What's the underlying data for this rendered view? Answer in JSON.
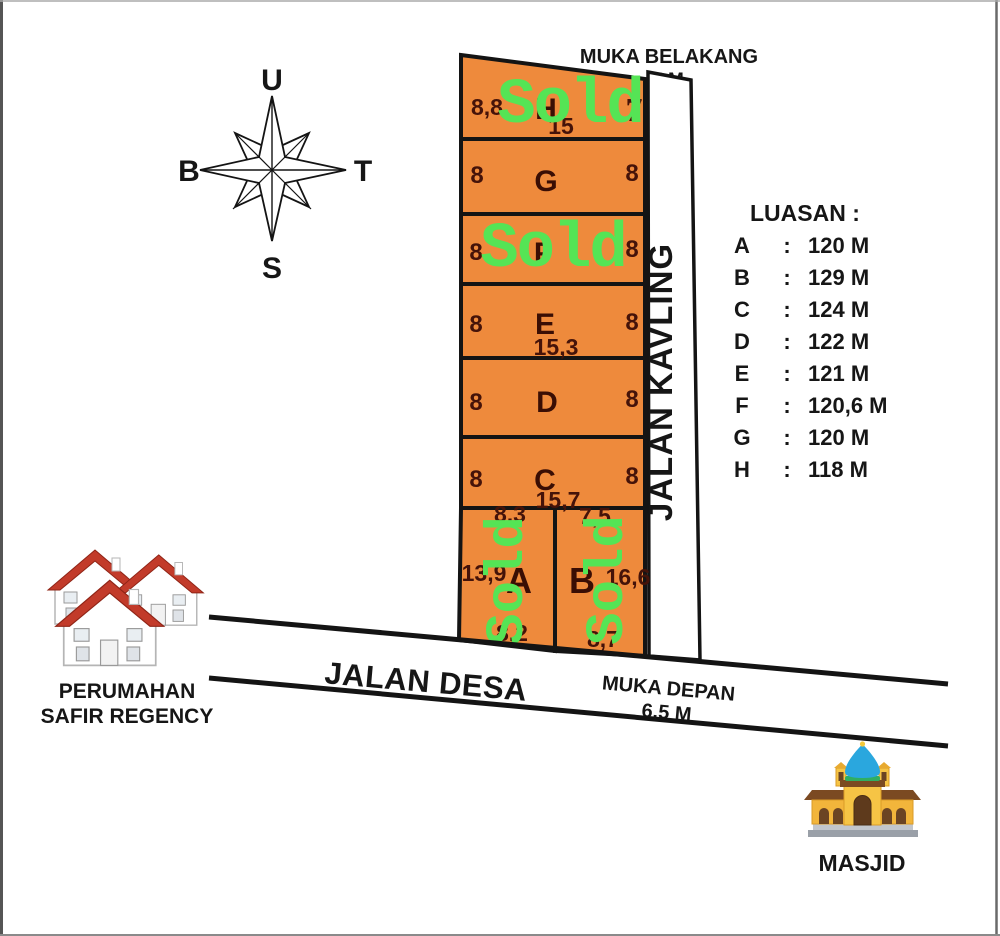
{
  "compass": {
    "north": "U",
    "east": "T",
    "south": "S",
    "west": "B"
  },
  "top_label": {
    "line1": "MUKA BELAKANG",
    "line2": "5 M"
  },
  "kavling_road": {
    "label": "JALAN KAVLING"
  },
  "main_road": {
    "label": "JALAN DESA"
  },
  "front_label": {
    "line1": "MUKA DEPAN",
    "line2": "6,5 M"
  },
  "legend": {
    "title": "LUASAN :",
    "colon": ":",
    "entries": [
      {
        "plot": "A",
        "area": "120 M"
      },
      {
        "plot": "B",
        "area": "129 M"
      },
      {
        "plot": "C",
        "area": "124 M"
      },
      {
        "plot": "D",
        "area": "122 M"
      },
      {
        "plot": "E",
        "area": "121 M"
      },
      {
        "plot": "F",
        "area": "120,6 M"
      },
      {
        "plot": "G",
        "area": "120 M"
      },
      {
        "plot": "H",
        "area": "118 M"
      }
    ]
  },
  "plots": {
    "sold_label": "Sold",
    "rows": [
      {
        "letter": "H",
        "left": "8,8",
        "bottom": "15",
        "right": "7",
        "sold": true
      },
      {
        "letter": "G",
        "left": "8",
        "right": "8",
        "sold": false
      },
      {
        "letter": "F",
        "left": "8",
        "right": "8",
        "sold": true
      },
      {
        "letter": "E",
        "left": "8",
        "bottom": "15,3",
        "right": "8",
        "sold": false
      },
      {
        "letter": "D",
        "left": "8",
        "right": "8",
        "sold": false
      },
      {
        "letter": "C",
        "left": "8",
        "bottom": "15,7",
        "right": "8",
        "sold": false
      }
    ],
    "plot_a": {
      "letter": "A",
      "top": "8,3",
      "left": "13,9",
      "bottom": "8,2",
      "sold": true
    },
    "plot_b": {
      "letter": "B",
      "top": "7,5",
      "right": "16,6",
      "bottom": "8,7",
      "sold": true
    }
  },
  "landmarks": {
    "housing": {
      "line1": "PERUMAHAN",
      "line2": "SAFIR REGENCY"
    },
    "mosque": {
      "label": "MASJID"
    }
  },
  "colors": {
    "plot_fill": "#EE8A3C",
    "plot_text": "#451309",
    "sold_green": "#55E455",
    "line_black": "#141414"
  }
}
